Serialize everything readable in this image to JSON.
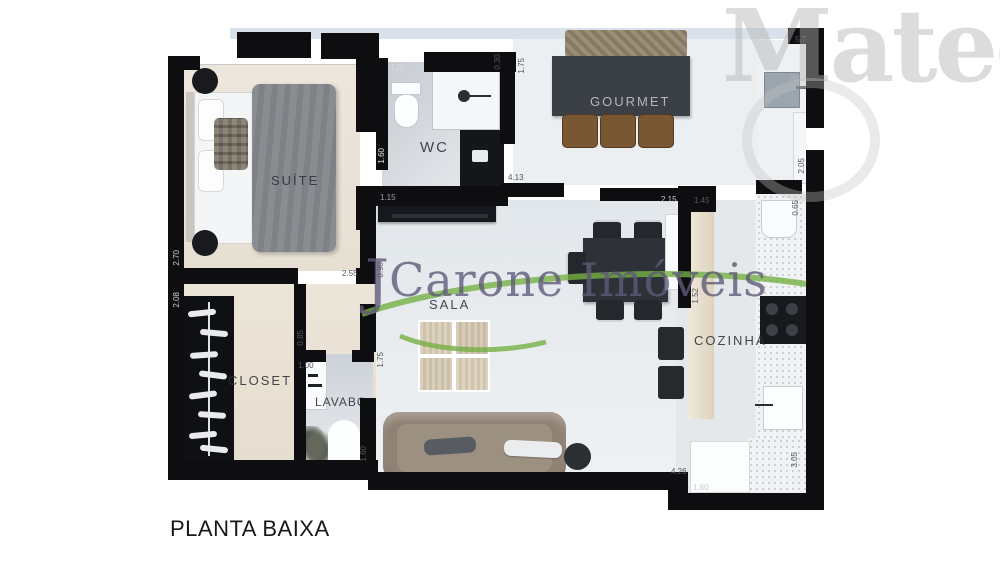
{
  "page": {
    "title": "PLANTA BAIXA"
  },
  "watermarks": {
    "realtor_initial": "J",
    "realtor": "Carone Imóveis",
    "builder": "Matec",
    "accent_green": "#76b043",
    "purple": "#5f5a78"
  },
  "rooms": {
    "suite": {
      "label": "SUÍTE"
    },
    "wc": {
      "label": "WC"
    },
    "gourmet": {
      "label": "GOURMET"
    },
    "sala": {
      "label": "SALA"
    },
    "cozinha": {
      "label": "COZINHA"
    },
    "closet": {
      "label": "CLOSET"
    },
    "lavabo": {
      "label": "LAVABO"
    }
  },
  "dims": [
    {
      "v": "0.30"
    },
    {
      "v": "1.80"
    },
    {
      "v": "1.60"
    },
    {
      "v": "1.75"
    },
    {
      "v": "4.13"
    },
    {
      "v": "5.7"
    },
    {
      "v": "2.05"
    },
    {
      "v": "0.65"
    },
    {
      "v": "2.15"
    },
    {
      "v": "1.45"
    },
    {
      "v": "1.52"
    },
    {
      "v": "1.15"
    },
    {
      "v": "2.70"
    },
    {
      "v": "2.08"
    },
    {
      "v": "2.55"
    },
    {
      "v": "0.90"
    },
    {
      "v": "0.85"
    },
    {
      "v": "1.00"
    },
    {
      "v": "1.75"
    },
    {
      "v": "1.60"
    },
    {
      "v": "4.26"
    },
    {
      "v": "1.60"
    },
    {
      "v": "3.05"
    }
  ],
  "colors": {
    "wall": "#0e0e10"
  }
}
